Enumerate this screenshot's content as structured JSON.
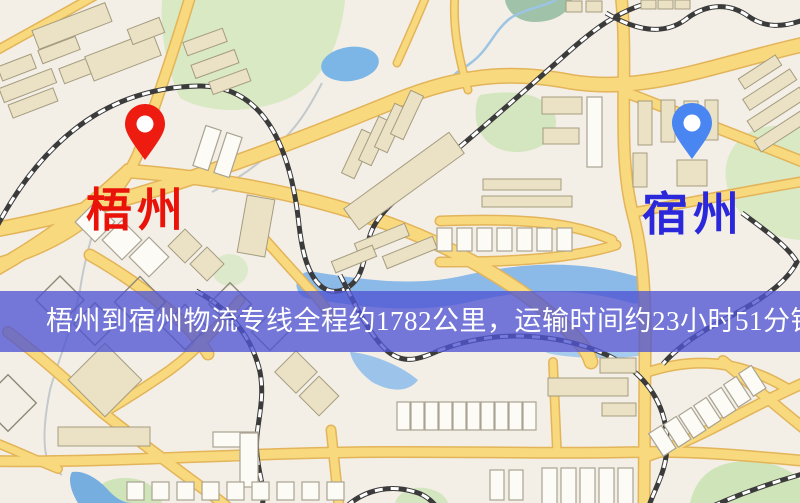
{
  "banner": {
    "text": "梧州到宿州物流专线全程约1782公里，运输时间约23小时51分钟.",
    "background_color": "#5054d2",
    "text_color": "#ffffff"
  },
  "markers": {
    "origin": {
      "label": "梧州",
      "pin_color": "#ee1b10",
      "label_color": "#e9130a"
    },
    "destination": {
      "label": "宿州",
      "pin_color": "#4a86f2",
      "label_color": "#2b28dc"
    }
  },
  "route_facts": {
    "origin": "梧州",
    "destination": "宿州",
    "distance_text": "约1782公里",
    "duration_text": "约23小时51分钟"
  },
  "map_palette": {
    "background": "#f3efe6",
    "road_fill": "#f8d97e",
    "road_casing": "#e3b459",
    "park_green": "#d9e9c3",
    "water_blue": "#7cb6e6",
    "railway_dark": "#3b3b3b",
    "building_fill": "#ebe2c6",
    "building_stroke": "#a59c80"
  }
}
